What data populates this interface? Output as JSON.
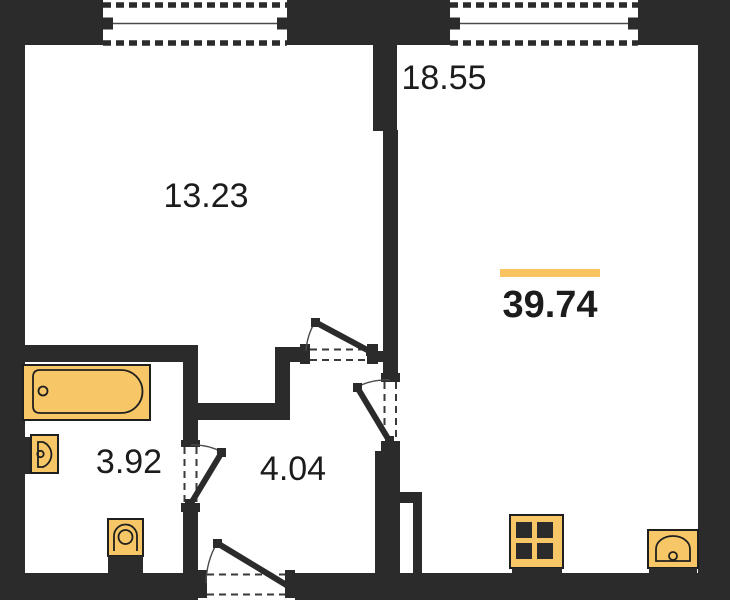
{
  "rooms": {
    "top_left": {
      "area_label": "13.23"
    },
    "right": {
      "area_label": "18.55"
    },
    "bathroom": {
      "area_label": "3.92"
    },
    "hallway": {
      "area_label": "4.04"
    }
  },
  "total": {
    "area_label": "39.74"
  },
  "colors": {
    "wall": "#2b2b2b",
    "fixture_fill": "#f7c767",
    "outline": "#1f1f1f",
    "accent_bar": "#f9c45f",
    "label_text": "#1c1c1c",
    "background": "#ffffff"
  },
  "icons": [
    "window-icon",
    "door-swing-icon",
    "bathtub-icon",
    "washbasin-icon",
    "toilet-icon",
    "stove-icon",
    "kitchen-sink-icon"
  ]
}
